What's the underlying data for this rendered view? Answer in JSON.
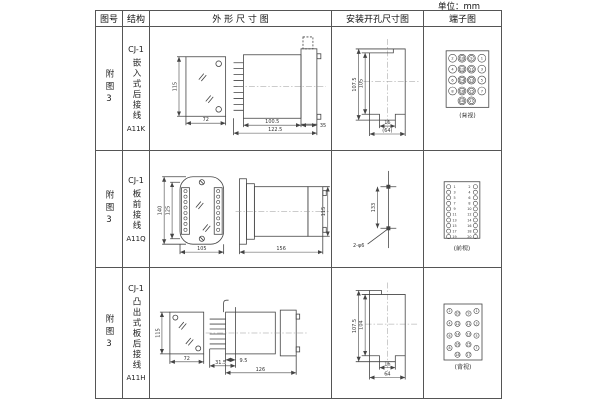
{
  "unit_label": "单位：mm",
  "headers": {
    "fig": "图号",
    "structure": "结构",
    "outline": "外 形 尺 寸 图",
    "mounting": "安装开孔尺寸图",
    "terminal": "端子图"
  },
  "rows": [
    {
      "fig_no": "附图3",
      "structure": {
        "model": "CJ-1",
        "mount_type": "嵌入式后接线",
        "code": "A11K"
      },
      "outline": {
        "front_height": "115",
        "front_width": "72",
        "body_depth": "100.5",
        "total_depth": "122.5",
        "flange_depth": "35"
      },
      "mounting": {
        "outer_height": "107.5",
        "inner_height": "105",
        "notch_width": "16",
        "total_width": "(64)"
      },
      "terminal": {
        "kind": "grid",
        "view_label": "(背视)",
        "grid": [
          [
            "2",
            "10",
            "9",
            "1"
          ],
          [
            "4",
            "12",
            "11",
            "3"
          ],
          [
            "6",
            "14",
            "13",
            "5"
          ],
          [
            "8",
            "16",
            "15",
            "7"
          ]
        ],
        "bottom": [
          "18",
          "17"
        ]
      }
    },
    {
      "fig_no": "附图3",
      "structure": {
        "model": "CJ-1",
        "mount_type": "板前接线",
        "code": "A11Q"
      },
      "outline": {
        "outer_height": "140",
        "inner_height": "125",
        "width": "105",
        "depth": "156",
        "body_height": "115"
      },
      "mounting": {
        "hole_spacing": "133",
        "hole_note": "2-φ6"
      },
      "terminal": {
        "kind": "pairs",
        "view_label": "(前视)",
        "pairs": [
          [
            "1",
            "2"
          ],
          [
            "3",
            "4"
          ],
          [
            "5",
            "6"
          ],
          [
            "7",
            "8"
          ],
          [
            "9",
            "10"
          ],
          [
            "11",
            "12"
          ],
          [
            "13",
            "14"
          ],
          [
            "15",
            "16"
          ],
          [
            "17",
            "18"
          ],
          [
            "19",
            "20"
          ]
        ]
      }
    },
    {
      "fig_no": "附图3",
      "structure": {
        "model": "CJ-1",
        "mount_type": "凸出式板后接线",
        "code": "A11H"
      },
      "outline": {
        "front_height": "115",
        "front_width": "72",
        "comb_depth": "31.5",
        "panel_offset": "9.5",
        "body_depth": "126"
      },
      "mounting": {
        "outer_height": "107.5",
        "inner_height": "104",
        "notch_width": "16",
        "total_width": "64"
      },
      "terminal": {
        "kind": "staggered",
        "view_label": "(背视)",
        "columns": [
          {
            "nums": [
              "2",
              "4",
              "6",
              "8"
            ]
          },
          {
            "nums": [
              "10",
              "12",
              "14",
              "16",
              "18"
            ]
          },
          {
            "nums": [
              "9",
              "11",
              "13",
              "15",
              "17"
            ]
          },
          {
            "nums": [
              "1",
              "3",
              "5",
              "7"
            ]
          }
        ]
      }
    }
  ]
}
